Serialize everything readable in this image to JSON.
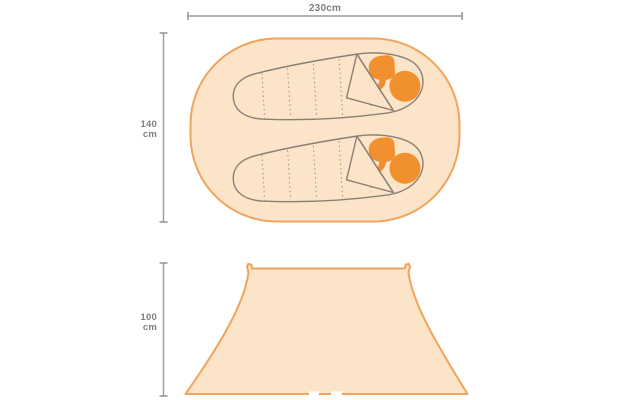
{
  "page": {
    "background": "#FFFFFF"
  },
  "diagram": {
    "subject": "tent-size-diagram",
    "labels": {
      "top_width": "230cm",
      "top_depth_value": "140",
      "top_depth_unit": "cm",
      "front_height_value": "100",
      "front_height_unit": "cm"
    },
    "top_view": {
      "sleeping_bag_count": 2
    },
    "colors": {
      "page_bg": "#FFFFFF",
      "tent_fill": "#FBE4C8",
      "tent_stroke": "#F0A45C",
      "accent_orange": "#F1902E",
      "bag_outline": "#8A8076",
      "seam_line": "#9B9186",
      "dim_line": "#9A9A9A",
      "dim_text": "#7E7E7E"
    }
  }
}
